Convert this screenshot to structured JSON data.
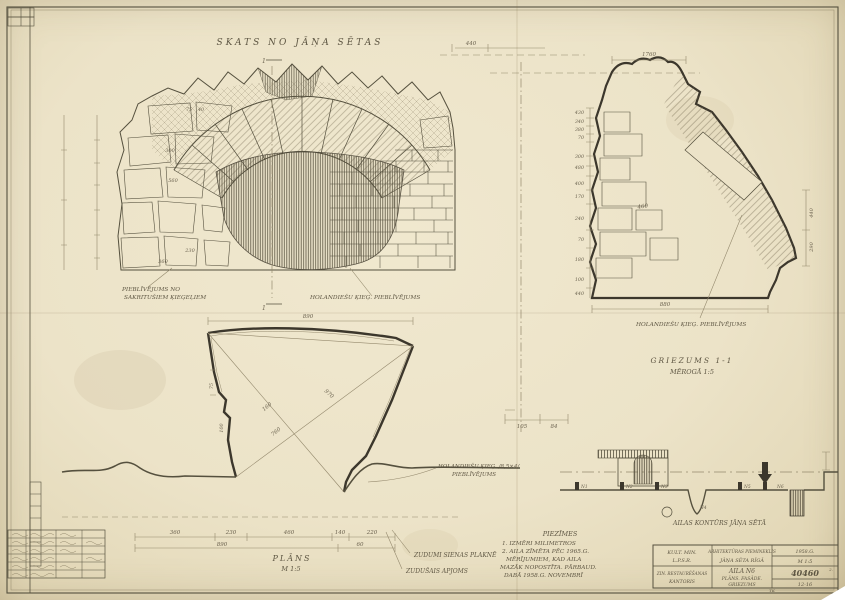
{
  "colors": {
    "paper": "#ece3c8",
    "ink": "#55503e",
    "heavy_line": "#3c372c",
    "pencil": "#94896d"
  },
  "titles": {
    "elevation": "SKATS NO JĀŅA SĒTAS",
    "plan": "PLĀNS",
    "plan_scale": "M 1:5",
    "section": "GRIEZUMS 1-1",
    "section_scale": "MĒROGĀ 1:5",
    "site": "AILAS KONTŪRS JĀŅA SĒTĀ",
    "cut_mark_top": "1",
    "cut_mark_bottom": "1"
  },
  "labels": {
    "fill_left1": "PIEBLĪVĒJUMS NO",
    "fill_left2": "SAKRITUŠIEM ĶIEĢEĻIEM",
    "fill_right": "HOLANDIEŠU ĶIEĢ. PIEBLĪVĒJUMS",
    "fill_section": "HOLANDIEŠU ĶIEĢ. PIEBLĪVĒJUMS",
    "fill_plan1": "HOLANDIEŠU ĶIEĢ. /8,5×4/",
    "fill_plan2": "PIEBLĪVĒJUMS",
    "loss1": "ZUDUMI SIENAS PLAKNĒ",
    "loss2": "ZUDUŠAIS APJOMS"
  },
  "notes": [
    "PIEZĪMES",
    "1. IZMĒRI MILIMETROS",
    "2. AILA ZĪMĒTA PĒC 1965.G.",
    "MĒRĪJUMIEM, KAD AILA",
    "MAZĀK NOPOSTĪTA. PĀRBAUD.",
    "DABĀ 1958.G. NOVEMBRĪ"
  ],
  "dims": {
    "elevation": {
      "top": "440",
      "s75": "75",
      "s40": "40",
      "stone1": "300",
      "stone2": "560",
      "stone3": "230",
      "stone4": "360"
    },
    "plan": {
      "top": "890",
      "diag1": "970",
      "diag2": "760",
      "diag3": "160",
      "edge1": "75",
      "edge2": "100",
      "chain": [
        "360",
        "230",
        "460",
        "140",
        "220"
      ],
      "chain2": [
        "890",
        "60"
      ]
    },
    "section": {
      "top": "1760",
      "stack": [
        "430",
        "340",
        "380",
        "70",
        "300",
        "480",
        "400",
        "170",
        "240",
        "70",
        "180",
        "100",
        "440"
      ],
      "inner": "460",
      "bottom": "880",
      "right1": "440",
      "right2": "290",
      "box1": "105",
      "box2": "84"
    }
  },
  "site": {
    "openings": [
      "N1",
      "N2",
      "N3",
      "N4",
      "N5",
      "N6"
    ]
  },
  "titleblock": {
    "org1a": "KULT. MIN.",
    "org1b": "L.P.S.R.",
    "org2a": "ZIN. RESTAURĒŠANAS",
    "org2b": "KANTORIS",
    "monument1": "ARHITEKTŪRAS PIEMINEKLIS",
    "monument2": "JĀŅA SĒTA RĪGĀ",
    "object1": "AILA N6",
    "object2": "PLĀNS. FASĀDE.",
    "object3": "GRIEZUMS",
    "date": "1958.G.",
    "scale": "M 1:5",
    "number": "40460",
    "code": "12-16",
    "sheet_no": "2.",
    "initials": "TK"
  }
}
